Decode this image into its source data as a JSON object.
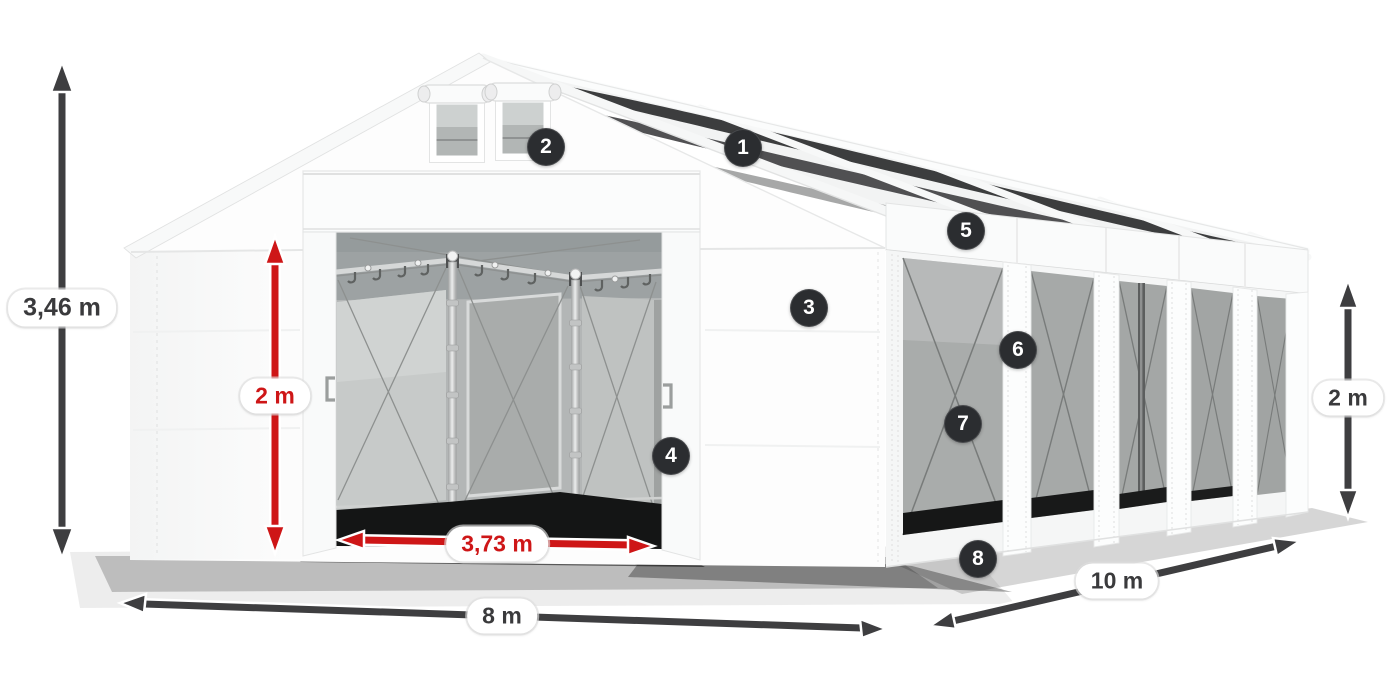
{
  "product_diagram": {
    "subject": "white PVC storage/party tent, 3D perspective view with gable roof, front entrance and mesh side windows",
    "background_color": "#ffffff",
    "fabric_color": "#f7f8f8",
    "roof_skylight_color": "#2e2f30",
    "mesh_window_color": "#a9acab"
  },
  "callout_markers": {
    "style": {
      "background": "#2b2d30",
      "text_color": "#ffffff"
    },
    "items": [
      {
        "number": "1"
      },
      {
        "number": "2"
      },
      {
        "number": "3"
      },
      {
        "number": "4"
      },
      {
        "number": "5"
      },
      {
        "number": "6"
      },
      {
        "number": "7"
      },
      {
        "number": "8"
      }
    ]
  },
  "dimension_labels": {
    "colors": {
      "dark": "#3a3a3c",
      "red": "#ce1617"
    },
    "items": [
      {
        "text": "3,46 m",
        "style": "dark",
        "placement": "total-height-left"
      },
      {
        "text": "2 m",
        "style": "red",
        "placement": "door-height"
      },
      {
        "text": "3,73 m",
        "style": "red",
        "placement": "door-width"
      },
      {
        "text": "8 m",
        "style": "dark",
        "placement": "front-width"
      },
      {
        "text": "10 m",
        "style": "dark",
        "placement": "side-length"
      },
      {
        "text": "2 m",
        "style": "dark",
        "placement": "side-wall-height"
      }
    ]
  }
}
